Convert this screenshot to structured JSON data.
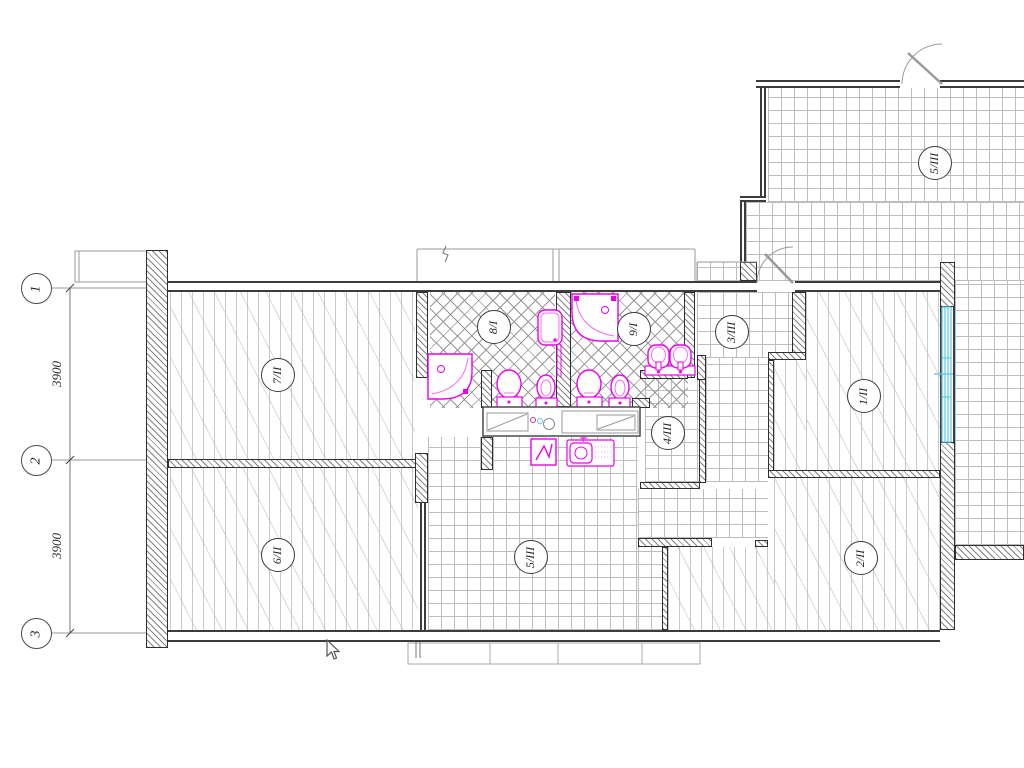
{
  "drawing_title": "Apartment floor plan with plumbing fixtures",
  "grid_axes": {
    "bubbles": [
      {
        "label": "1"
      },
      {
        "label": "2"
      },
      {
        "label": "3"
      }
    ]
  },
  "dimensions": {
    "between_1_2": "3900",
    "between_2_3": "3900"
  },
  "room_markers": [
    {
      "label": "7/II"
    },
    {
      "label": "8/I"
    },
    {
      "label": "9/I"
    },
    {
      "label": "3/III"
    },
    {
      "label": "1/II"
    },
    {
      "label": "5/III"
    },
    {
      "label": "4/III"
    },
    {
      "label": "5/III"
    },
    {
      "label": "6/II"
    },
    {
      "label": "2/II"
    }
  ],
  "fixtures": [
    "corner-bathtub-left",
    "shower-tub",
    "corner-bathtub-right",
    "toilet",
    "bidet",
    "toilet",
    "bidet",
    "double-washbasin",
    "kitchen-counter-with-sinks",
    "stove",
    "washing-machine-sink"
  ],
  "colors": {
    "fixture_magenta": "#ee00ee",
    "window_cyan": "#58c8e8",
    "wall_line": "#3c3c3c",
    "hatch_gray": "#8a8a8a"
  }
}
